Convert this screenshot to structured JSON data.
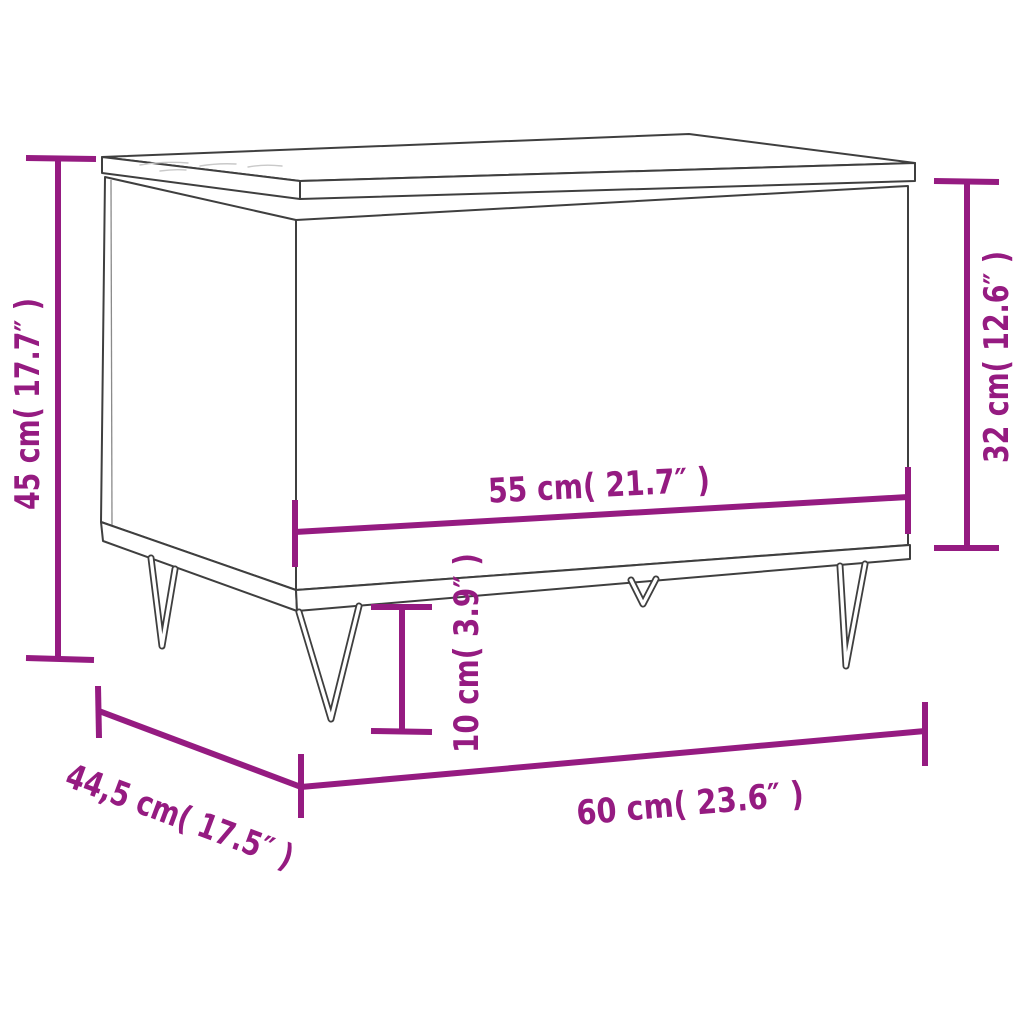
{
  "image": {
    "kind": "product-dimension-diagram",
    "subject": "coffee table with hairpin legs, line drawing in perspective",
    "background_color": "#FFFFFF",
    "outline_color": "#3F3F3F",
    "dimension_color": "#951B81"
  },
  "dimensions": {
    "overall_height": {
      "label": "45 cm( 17.7″ )",
      "cm": "45",
      "inches": "17.7",
      "orientation": "vertical",
      "position": "left-side"
    },
    "body_height": {
      "label": "32 cm( 12.6″ )",
      "cm": "32",
      "inches": "12.6",
      "orientation": "vertical",
      "position": "right-side"
    },
    "inner_width": {
      "label": "55 cm( 21.7″ )",
      "cm": "55",
      "inches": "21.7",
      "orientation": "horizontal",
      "position": "on-front-face"
    },
    "leg_height": {
      "label": "10 cm( 3.9″ )",
      "cm": "10",
      "inches": "3.9",
      "orientation": "vertical",
      "position": "below-front-left"
    },
    "overall_width": {
      "label": "60 cm( 23.6″ )",
      "cm": "60",
      "inches": "23.6",
      "orientation": "horizontal",
      "position": "bottom"
    },
    "depth": {
      "label": "44,5 cm( 17.5″ )",
      "cm": "44,5",
      "inches": "17.5",
      "orientation": "diagonal",
      "position": "bottom-left"
    }
  }
}
